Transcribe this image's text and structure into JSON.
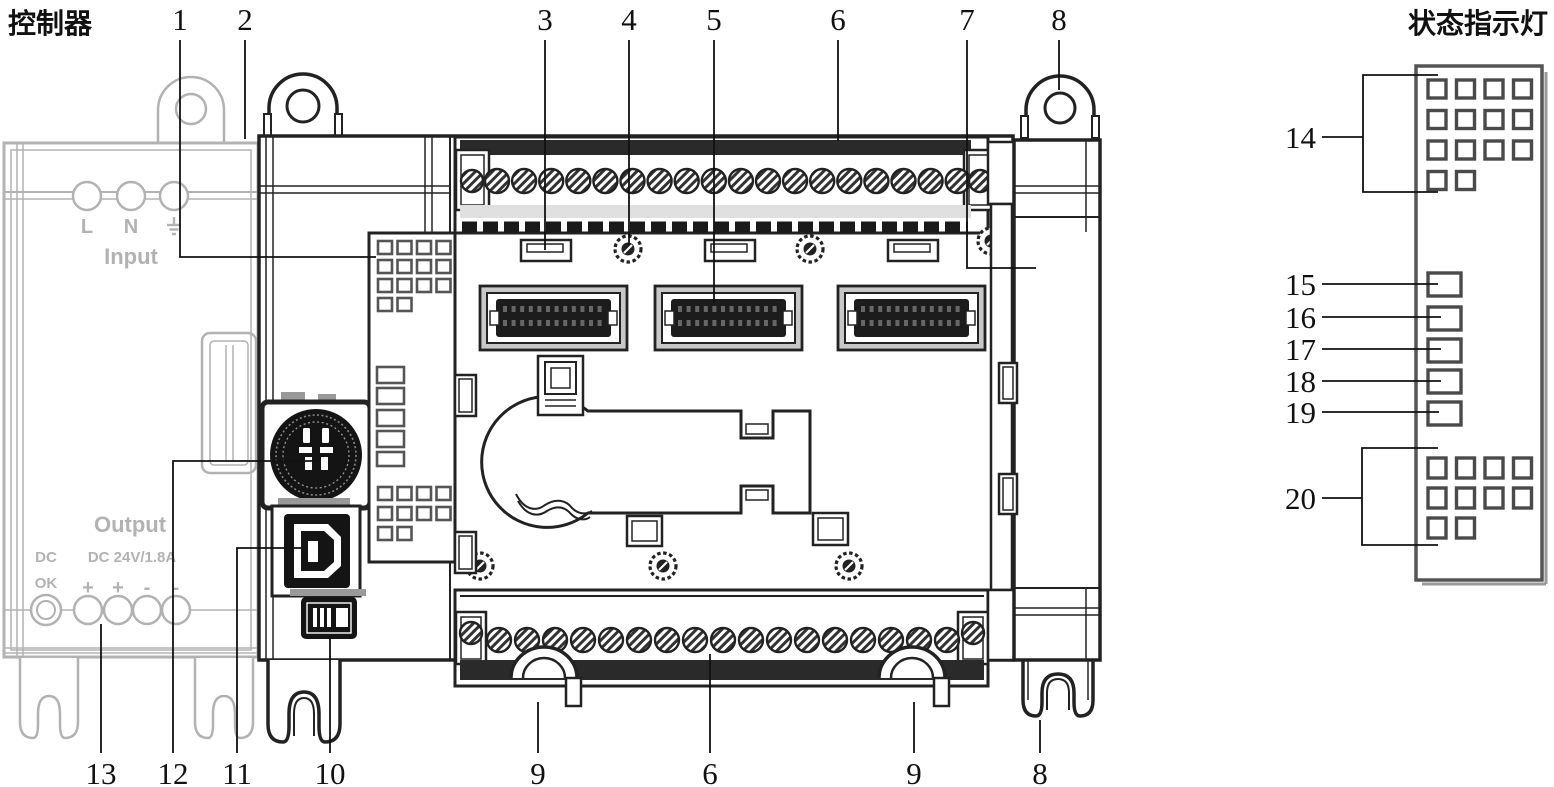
{
  "figure": {
    "label_left": "控制器",
    "label_right": "状态指示灯"
  },
  "power_supply": {
    "terminal_labels": [
      "L",
      "N"
    ],
    "ground_icon": "earth-ground",
    "input_label": "Input",
    "output_label": "Output",
    "dc_ok_line1": "DC",
    "dc_ok_line2": "OK",
    "rating": "DC 24V/1.8A",
    "polarity": [
      "+",
      "+",
      "-",
      "-"
    ]
  },
  "callouts": {
    "top": [
      "1",
      "2",
      "3",
      "4",
      "5",
      "6",
      "7",
      "8"
    ],
    "bottom": [
      "13",
      "12",
      "11",
      "10",
      "9",
      "6",
      "9",
      "8"
    ],
    "right": [
      "14",
      "15",
      "16",
      "17",
      "18",
      "19",
      "20"
    ]
  }
}
